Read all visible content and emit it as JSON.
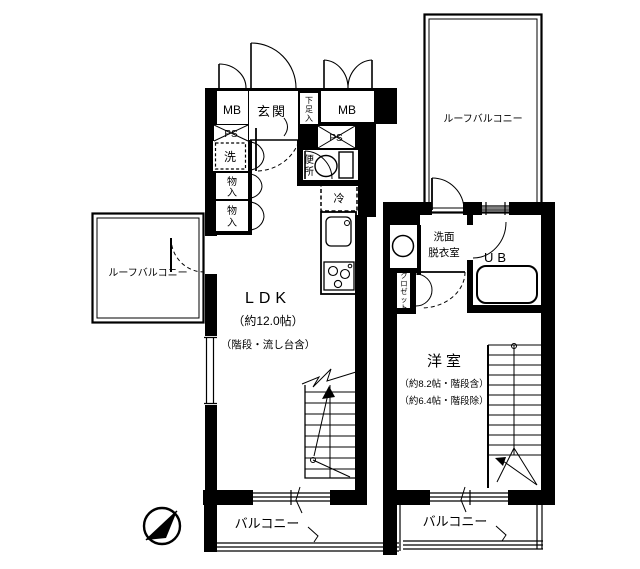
{
  "plan": {
    "floor1": {
      "meter_box_left": "MB",
      "entrance": "玄関",
      "shoe_box": "下足入",
      "meter_box_right": "MB",
      "pipe_space_left": "PS",
      "pipe_space_right": "PS",
      "laundry": "洗",
      "storage1": "物入",
      "storage2": "物入",
      "toilet": "便所",
      "fridge": "冷",
      "ldk_name": "LDK",
      "ldk_size": "（約12.0帖）",
      "ldk_note": "（階段・流し台含）",
      "roof_balcony_left": "ルーフバルコニー",
      "balcony": "バルコニー"
    },
    "floor2": {
      "roof_balcony": "ルーフバルコニー",
      "washroom_line1": "洗面",
      "washroom_line2": "脱衣室",
      "unit_bath": "UB",
      "closet": "クロゼット",
      "room_name": "洋室",
      "room_size_incl": "（約8.2帖・階段含）",
      "room_size_excl": "（約6.4帖・階段除）",
      "balcony": "バルコニー"
    },
    "colors": {
      "ink": "#000000",
      "paper": "#ffffff"
    }
  }
}
